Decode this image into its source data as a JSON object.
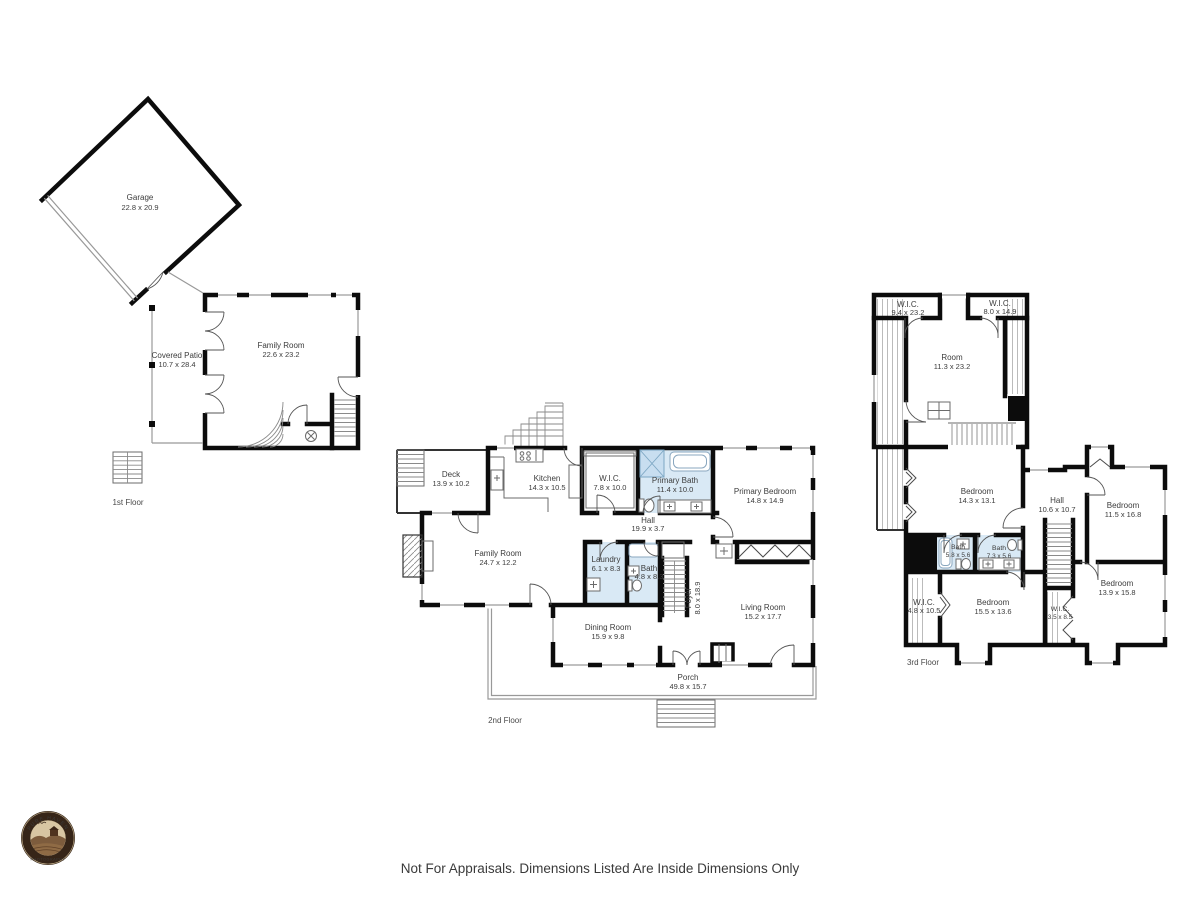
{
  "footer": {
    "disclaimer": "Not For Appraisals. Dimensions Listed Are Inside Dimensions Only"
  },
  "logo": {
    "name": "PURE HAVEN",
    "subtitle": "PHOTOGRAPHY"
  },
  "colors": {
    "wall": "#0c0c0c",
    "bathroom_fill": "#d9e9f5",
    "label_text": "#3c3c3c"
  },
  "floors": {
    "first": {
      "label": "1st Floor",
      "rooms": [
        {
          "name": "Garage",
          "dims": "22.8 x 20.9"
        },
        {
          "name": "Covered Patio",
          "dims": "10.7 x 28.4"
        },
        {
          "name": "Family Room",
          "dims": "22.6 x 23.2"
        }
      ]
    },
    "second": {
      "label": "2nd Floor",
      "rooms": [
        {
          "name": "Deck",
          "dims": "13.9 x 10.2"
        },
        {
          "name": "Kitchen",
          "dims": "14.3 x 10.5"
        },
        {
          "name": "W.I.C.",
          "dims": "7.8 x 10.0"
        },
        {
          "name": "Primary Bath",
          "dims": "11.4 x 10.0"
        },
        {
          "name": "Primary Bedroom",
          "dims": "14.8 x 14.9"
        },
        {
          "name": "Hall",
          "dims": "19.9 x 3.7"
        },
        {
          "name": "Family Room",
          "dims": "24.7 x 12.2"
        },
        {
          "name": "Laundry",
          "dims": "6.1 x 8.3"
        },
        {
          "name": "Bath",
          "dims": "4.8 x 8.3"
        },
        {
          "name": "Foyer",
          "dims": "8.0 x 18.9"
        },
        {
          "name": "Dining Room",
          "dims": "15.9 x 9.8"
        },
        {
          "name": "Living Room",
          "dims": "15.2 x 17.7"
        },
        {
          "name": "Porch",
          "dims": "49.8 x 15.7"
        }
      ]
    },
    "third": {
      "label": "3rd Floor",
      "rooms": [
        {
          "name": "W.I.C.",
          "dims": "9.4 x 23.2"
        },
        {
          "name": "W.I.C.",
          "dims": "8.0 x 14.9"
        },
        {
          "name": "Room",
          "dims": "11.3 x 23.2"
        },
        {
          "name": "Bedroom",
          "dims": "14.3 x 13.1"
        },
        {
          "name": "Hall",
          "dims": "10.6 x 10.7"
        },
        {
          "name": "Bedroom",
          "dims": "11.5 x 16.8"
        },
        {
          "name": "Bath",
          "dims": "5.8 x 5.6"
        },
        {
          "name": "Bath",
          "dims": "7.3 x 5.6"
        },
        {
          "name": "W.I.C.",
          "dims": "4.8 x 10.5"
        },
        {
          "name": "Bedroom",
          "dims": "15.5 x 13.6"
        },
        {
          "name": "W.I.C.",
          "dims": "3.5 x 8.5"
        },
        {
          "name": "Bedroom",
          "dims": "13.9 x 15.8"
        }
      ]
    }
  }
}
